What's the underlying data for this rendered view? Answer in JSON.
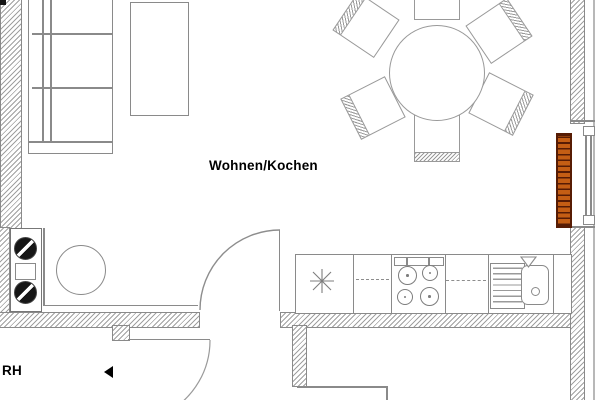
{
  "labels": {
    "room": "Wohnen/Kochen",
    "annotation": "RH"
  },
  "colors": {
    "line": "#8a8a8a",
    "hatch": "#a0a0a0",
    "radiator-fill": "#c45e14",
    "radiator-line": "#571c04",
    "text": "#000000"
  },
  "icons": [
    "left-arrow-marker-icon",
    "asterisk-symbol-icon",
    "tap-triangle-icon",
    "hotplate-icon",
    "burner-icon"
  ],
  "furniture": [
    "sofa",
    "coffee-table",
    "dining-table",
    "dining-chair x6",
    "radiator",
    "window",
    "door-swing x2",
    "kitchen-counter",
    "dishwasher-dashed",
    "cooktop-4-burner",
    "drainer",
    "sink",
    "hob-2-plate",
    "round-table"
  ]
}
